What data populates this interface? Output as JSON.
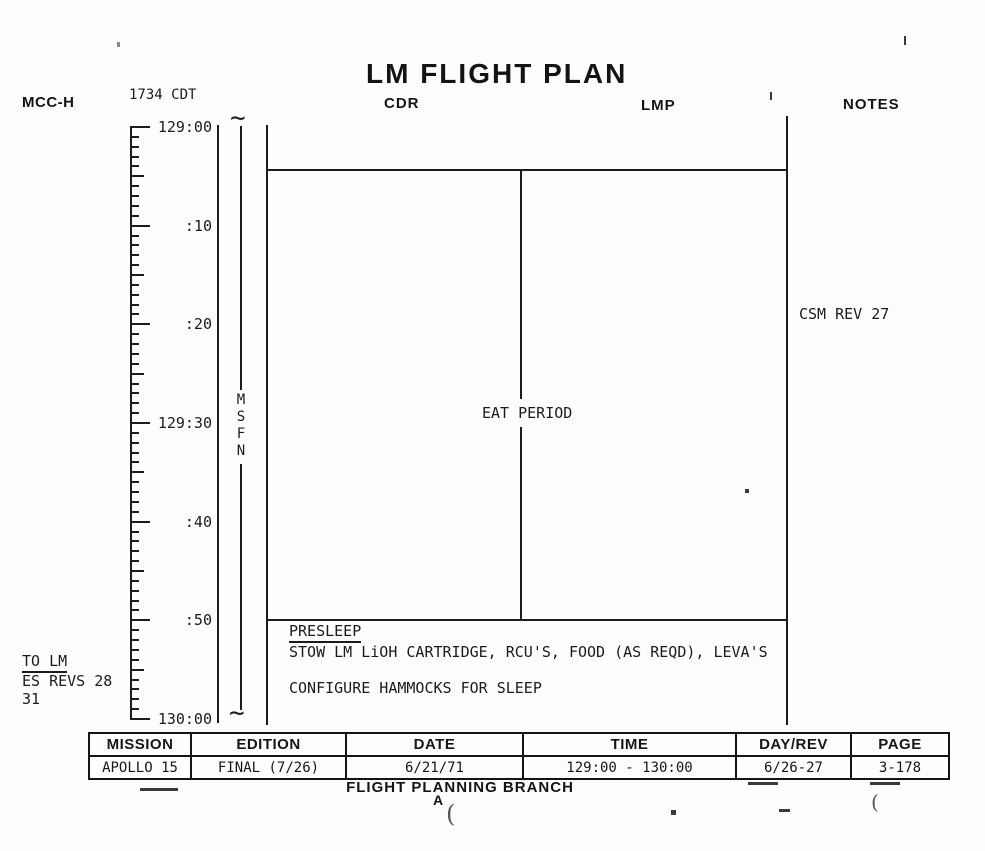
{
  "header": {
    "mcch_label": "MCC-H",
    "cdt_label": "1734 CDT",
    "title": "LM FLIGHT PLAN",
    "cdr_label": "CDR",
    "lmp_label": "LMP",
    "notes_label": "NOTES"
  },
  "timeline": {
    "duration_minutes": 60,
    "tick_labels": [
      "129:00",
      ":10",
      ":20",
      "129:30",
      ":40",
      ":50",
      "130:00"
    ],
    "network_label": "MSFN",
    "break_symbol": "~"
  },
  "plan": {
    "eat_period": "EAT PERIOD",
    "presleep_heading": "PRESLEEP",
    "presleep_item1": "STOW LM LiOH CARTRIDGE, RCU'S, FOOD (AS REQD), LEVA'S",
    "presleep_item2": "CONFIGURE HAMMOCKS FOR SLEEP"
  },
  "notes_column": {
    "csm_rev": "CSM REV 27"
  },
  "margin_notes": {
    "to_lm": "TO LM",
    "es_revs": "ES REVS 28",
    "es_revs_cont": "31"
  },
  "footer_table": {
    "columns": [
      {
        "header": "MISSION",
        "value": "APOLLO 15"
      },
      {
        "header": "EDITION",
        "value": "FINAL (7/26)"
      },
      {
        "header": "DATE",
        "value": "6/21/71"
      },
      {
        "header": "TIME",
        "value": "129:00 - 130:00"
      },
      {
        "header": "DAY/REV",
        "value": "6/26-27"
      },
      {
        "header": "PAGE",
        "value": "3-178"
      }
    ]
  },
  "footer": {
    "branch_label": "FLIGHT PLANNING BRANCH",
    "stamp_artifact": "A"
  }
}
